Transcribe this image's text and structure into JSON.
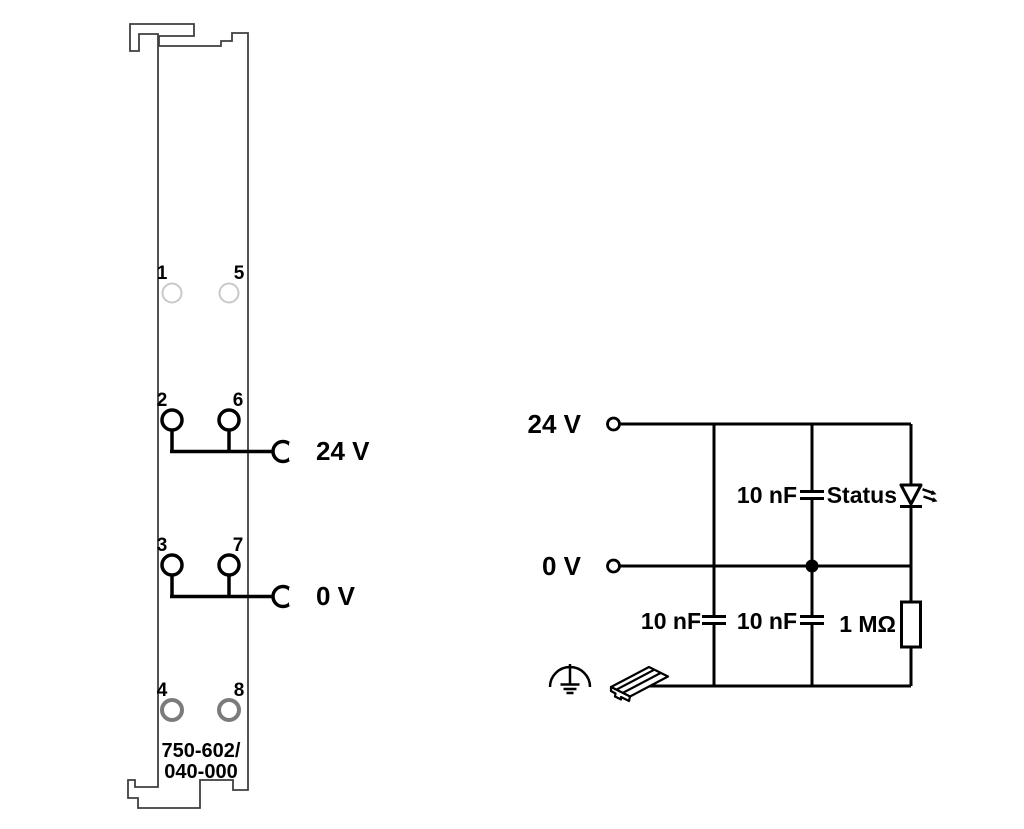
{
  "module": {
    "part_number": {
      "line1": "750-602/",
      "line2": "040-000"
    },
    "rows": [
      {
        "left_num": "1",
        "right_num": "5",
        "type": "unused-light"
      },
      {
        "left_num": "2",
        "right_num": "6",
        "type": "supply",
        "label": "24 V"
      },
      {
        "left_num": "3",
        "right_num": "7",
        "type": "supply",
        "label": "0 V"
      },
      {
        "left_num": "4",
        "right_num": "8",
        "type": "unused-dark"
      }
    ]
  },
  "circuit": {
    "rail_24v_label": "24 V",
    "rail_0v_label": "0 V",
    "cap_top_label": "10 nF",
    "cap_bottom_left_label": "10 nF",
    "cap_bottom_mid_label": "10 nF",
    "led_label": "Status",
    "resistor_label": "1 MΩ"
  },
  "colors": {
    "background": "#ffffff",
    "line": "#000000",
    "module_outline": "#3f3f3f",
    "terminal_unused_top": "#c9c9c9",
    "terminal_unused_bottom": "#7b7b7b"
  }
}
